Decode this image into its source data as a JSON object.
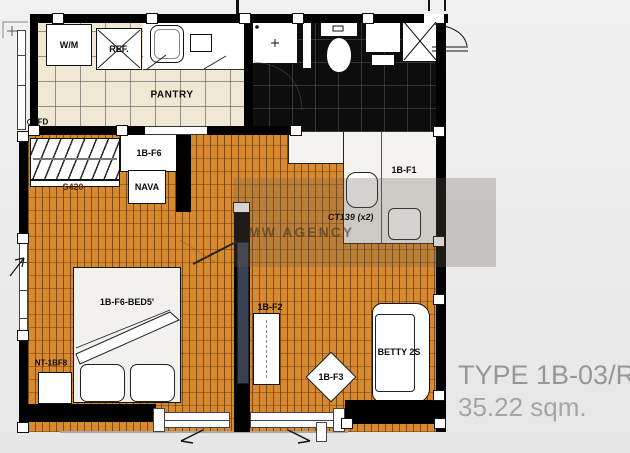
{
  "title": {
    "type": "TYPE 1B-03/R",
    "area": "35.22 sqm."
  },
  "watermark": {
    "text": "MW AGENCY"
  },
  "rooms": {
    "pantry": "PANTRY"
  },
  "annotations": {
    "floor_drain": "FD"
  },
  "furniture": {
    "washing_machine": "W/M",
    "refrigerator": "REF.",
    "wardrobe": "1B-F6",
    "side_table": "NAVA",
    "rug": "S420",
    "bed": "1B-F6-BED5'",
    "nightstand": "NT-1BF8",
    "kitchen_counter": "1B-F1",
    "chairs": "CT139 (x2)",
    "tv_console": "1B-F2",
    "coffee_table": "1B-F3",
    "sofa": "BETTY 2S"
  },
  "colors": {
    "wood_floor": "#d88b2e",
    "wood_grout": "#683708",
    "pantry_tile": "#efe8d4",
    "bath_floor": "#0d0d0d",
    "wall": "#000000",
    "title_text": "#979797",
    "watermark_tint": "rgba(104,94,82,0.28)"
  }
}
